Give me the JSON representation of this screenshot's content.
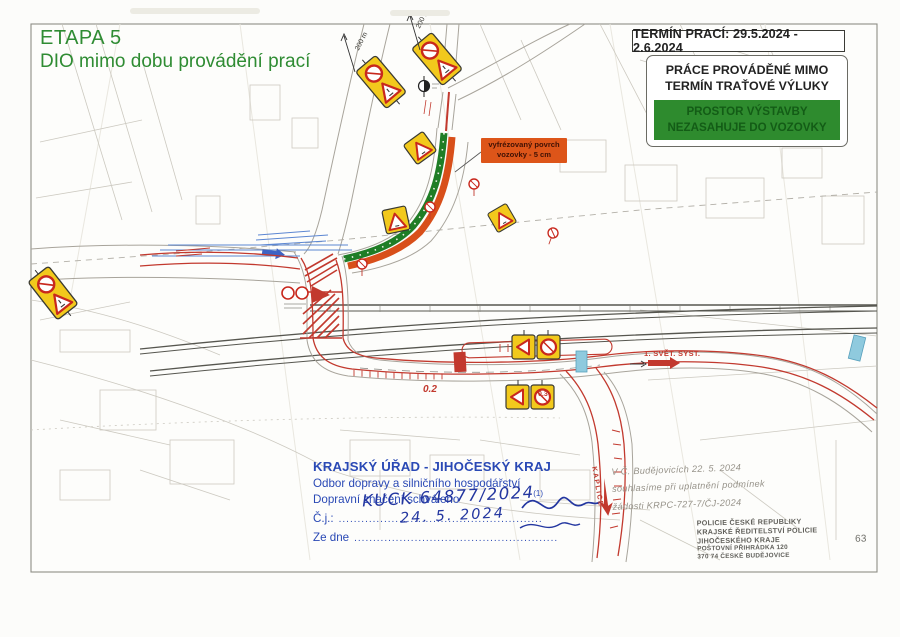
{
  "header": {
    "etapa_title": "ETAPA 5",
    "dio_subtitle": "DIO mimo dobu provádění prací",
    "termin_box": "TERMÍN PRACÍ: 29.5.2024 - 2.6.2024",
    "prace_line1": "PRÁCE PROVÁDĚNÉ MIMO",
    "prace_line2": "TERMÍN TRAŤOVÉ VÝLUKY",
    "prostor_line1": "PROSTOR VÝSTAVBY",
    "prostor_line2": "NEZASAHUJE DO VOZOVKY"
  },
  "map": {
    "milled_line1": "vyfrézovaný povrch",
    "milled_line2": "vozovky - 5 cm",
    "distance_label_1": "200 m",
    "distance_label_2": "200 m",
    "direction_east": "1. SVĚT. SYST.",
    "direction_south": "KAPLICE",
    "chainage_1": "0.2",
    "chainage_2": "0.3"
  },
  "approval_stamp": {
    "authority": "KRAJSKÝ ÚŘAD - JIHOČESKÝ KRAJ",
    "department": "Odbor dopravy a silničního hospodářství",
    "approval_text": "Dopravní značení schváleno",
    "approval_note": "(1)",
    "ref_label": "Č.j.:",
    "ref_dots": "......................................................",
    "ref_value": "KUCK 64877/2024",
    "date_label": "Ze dne",
    "date_dots": "......................................................",
    "date_value": "24. 5. 2024"
  },
  "handwritten_note": {
    "line1": "V Č. Budějovicích 22. 5. 2024",
    "line2": "souhlasíme při uplatnění podmínek",
    "line3": "žádosti KRPC-727-7/ČJ-2024"
  },
  "police_stamp": {
    "line1": "POLICIE ČESKÉ REPUBLIKY",
    "line2": "KRAJSKÉ ŘEDITELSTVÍ POLICIE",
    "line3": "JIHOČESKÉHO KRAJE",
    "line3_number": "63",
    "line4": "POŠTOVNÍ PŘIHRÁDKA 120",
    "line5": "370 74 ČESKÉ BUDĚJOVICE"
  },
  "colors": {
    "title_green": "#2f8c33",
    "zone_green": "#2e8b2e",
    "zone_green_text": "#135c16",
    "milled_orange": "#dd5519",
    "traffic_red": "#c2392e",
    "stamp_blue": "#2a49b5",
    "sign_yellow": "#f2c91c"
  }
}
